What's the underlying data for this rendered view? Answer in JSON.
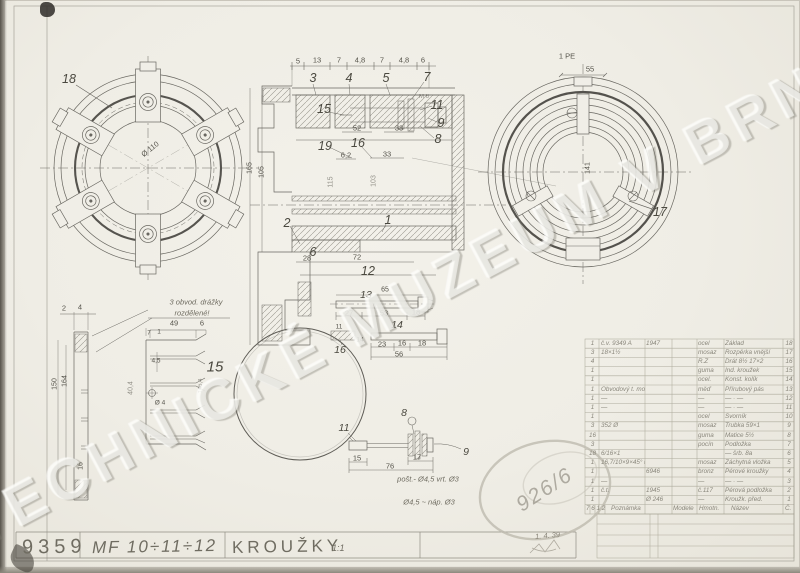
{
  "watermark": "TECHNICKÉ MUZEUM V BRNĚ",
  "title_block": {
    "drawing_number": "9359",
    "model": "MF 10÷11÷12",
    "title": "KROUŽKY",
    "scale": "1:1",
    "date": "1. 4. 39",
    "stamp": "926/6"
  },
  "notes": {
    "groove1": "3 obvod. drážky",
    "groove2": "rozdělené!",
    "hole1": "pošt.- Ø4,5 vrt. Ø3",
    "hole2": "Ø4,5 ~ náp. Ø3",
    "thread": "M 6",
    "plate": "1 PE"
  },
  "balloons": {
    "n1": "1",
    "n2": "2",
    "n3": "3",
    "n4": "4",
    "n5": "5",
    "n6": "6",
    "n7": "7",
    "n8": "8",
    "n9": "9",
    "n11": "11",
    "n12": "12",
    "n15": "15",
    "n16": "16",
    "n17": "17",
    "n18": "18",
    "n19": "19",
    "b8": "8",
    "b9": "9",
    "b11": "11",
    "b13": "13",
    "b14": "14",
    "b15": "15",
    "b16": "16"
  },
  "dims": {
    "sec_top": [
      "5",
      "13",
      "7",
      "4,8",
      "7",
      "4,8",
      "6"
    ],
    "s52": "52",
    "s33a": "33",
    "s62": "6,2",
    "s33b": "33",
    "s72": "72",
    "s28": "28",
    "s165": "165",
    "s105": "105",
    "s115": "115",
    "s103": "103",
    "l110": "Ø 110",
    "r55": "55",
    "r141": "141",
    "g2": "2",
    "g4": "4",
    "g150": "150",
    "g164": "164",
    "g16": "16",
    "g404": "40,4",
    "p49": "49",
    "p6": "6",
    "p7": "7",
    "p1": "1",
    "p45": "4,5",
    "pd4": "Ø 4",
    "p146": "146,4",
    "q65": "65",
    "q27": "27",
    "q53": "53",
    "q18": "18",
    "w23": "23",
    "w16": "16",
    "w18": "18",
    "w56": "56",
    "v11": "11",
    "v14": "14",
    "a15": "15",
    "a17": "17",
    "a76": "76"
  },
  "table": {
    "rows": [
      {
        "qty": "1",
        "ref": "č.v. 9349 A",
        "num": "1947",
        "mat": "ocel",
        "name": "Základ",
        "pos": "18"
      },
      {
        "qty": "3",
        "ref": "18×1½",
        "num": "",
        "mat": "mosaz",
        "name": "Rozpěrka vnější",
        "pos": "17"
      },
      {
        "qty": "4",
        "ref": "",
        "num": "",
        "mat": "R.Z",
        "name": "Drát 8½ 17×2",
        "pos": "16"
      },
      {
        "qty": "1",
        "ref": "",
        "num": "",
        "mat": "guma",
        "name": "Ind. kroužek",
        "pos": "15"
      },
      {
        "qty": "1",
        "ref": "",
        "num": "",
        "mat": "ocel.",
        "name": "Konst. kolík",
        "pos": "14"
      },
      {
        "qty": "1",
        "ref": "Obvodový t. mosazný ¼ m.",
        "num": "",
        "mat": "měď",
        "name": "Přírubový pás",
        "pos": "13"
      },
      {
        "qty": "1",
        "ref": "—",
        "num": "",
        "mat": "—",
        "name": "— · —",
        "pos": "12"
      },
      {
        "qty": "1",
        "ref": "—",
        "num": "",
        "mat": "—",
        "name": "— · —",
        "pos": "11"
      },
      {
        "qty": "1",
        "ref": "",
        "num": "",
        "mat": "ocel",
        "name": "Svorník",
        "pos": "10"
      },
      {
        "qty": "3",
        "ref": "352 Ø",
        "num": "",
        "mat": "mosaz",
        "name": "Trubka 59×1",
        "pos": "9"
      },
      {
        "qty": "16",
        "ref": "",
        "num": "",
        "mat": "guma",
        "name": "Matice 5½",
        "pos": "8"
      },
      {
        "qty": "3",
        "ref": "",
        "num": "",
        "mat": "pocín",
        "name": "Podložka",
        "pos": "7"
      },
      {
        "qty": "18",
        "ref": "6/16×1",
        "num": "",
        "mat": "",
        "name": "— šrb. 8a",
        "pos": "6"
      },
      {
        "qty": "1",
        "ref": "16,7/10×9×45° Ø",
        "num": "",
        "mat": "mosaz",
        "name": "Záchytná vložka",
        "pos": "5"
      },
      {
        "qty": "1",
        "ref": "",
        "num": "6946",
        "mat": "bronz",
        "name": "Pérové kroužky",
        "pos": "4"
      },
      {
        "qty": "1",
        "ref": "—",
        "num": "",
        "mat": "—",
        "name": "— · —",
        "pos": "3"
      },
      {
        "qty": "1",
        "ref": "č.t.",
        "num": "1945",
        "mat": "č.117",
        "name": "Pérová podložka",
        "pos": "2"
      },
      {
        "qty": "1",
        "ref": "",
        "num": "Ø 246",
        "mat": "—",
        "name": "Kroužk. před.",
        "pos": "1"
      }
    ],
    "footer": {
      "mini": "7 6 1 2",
      "note": "Poznámka",
      "c1": "Modele",
      "c2": "Hmotn.",
      "c3": "Název",
      "c4": "Č."
    }
  }
}
